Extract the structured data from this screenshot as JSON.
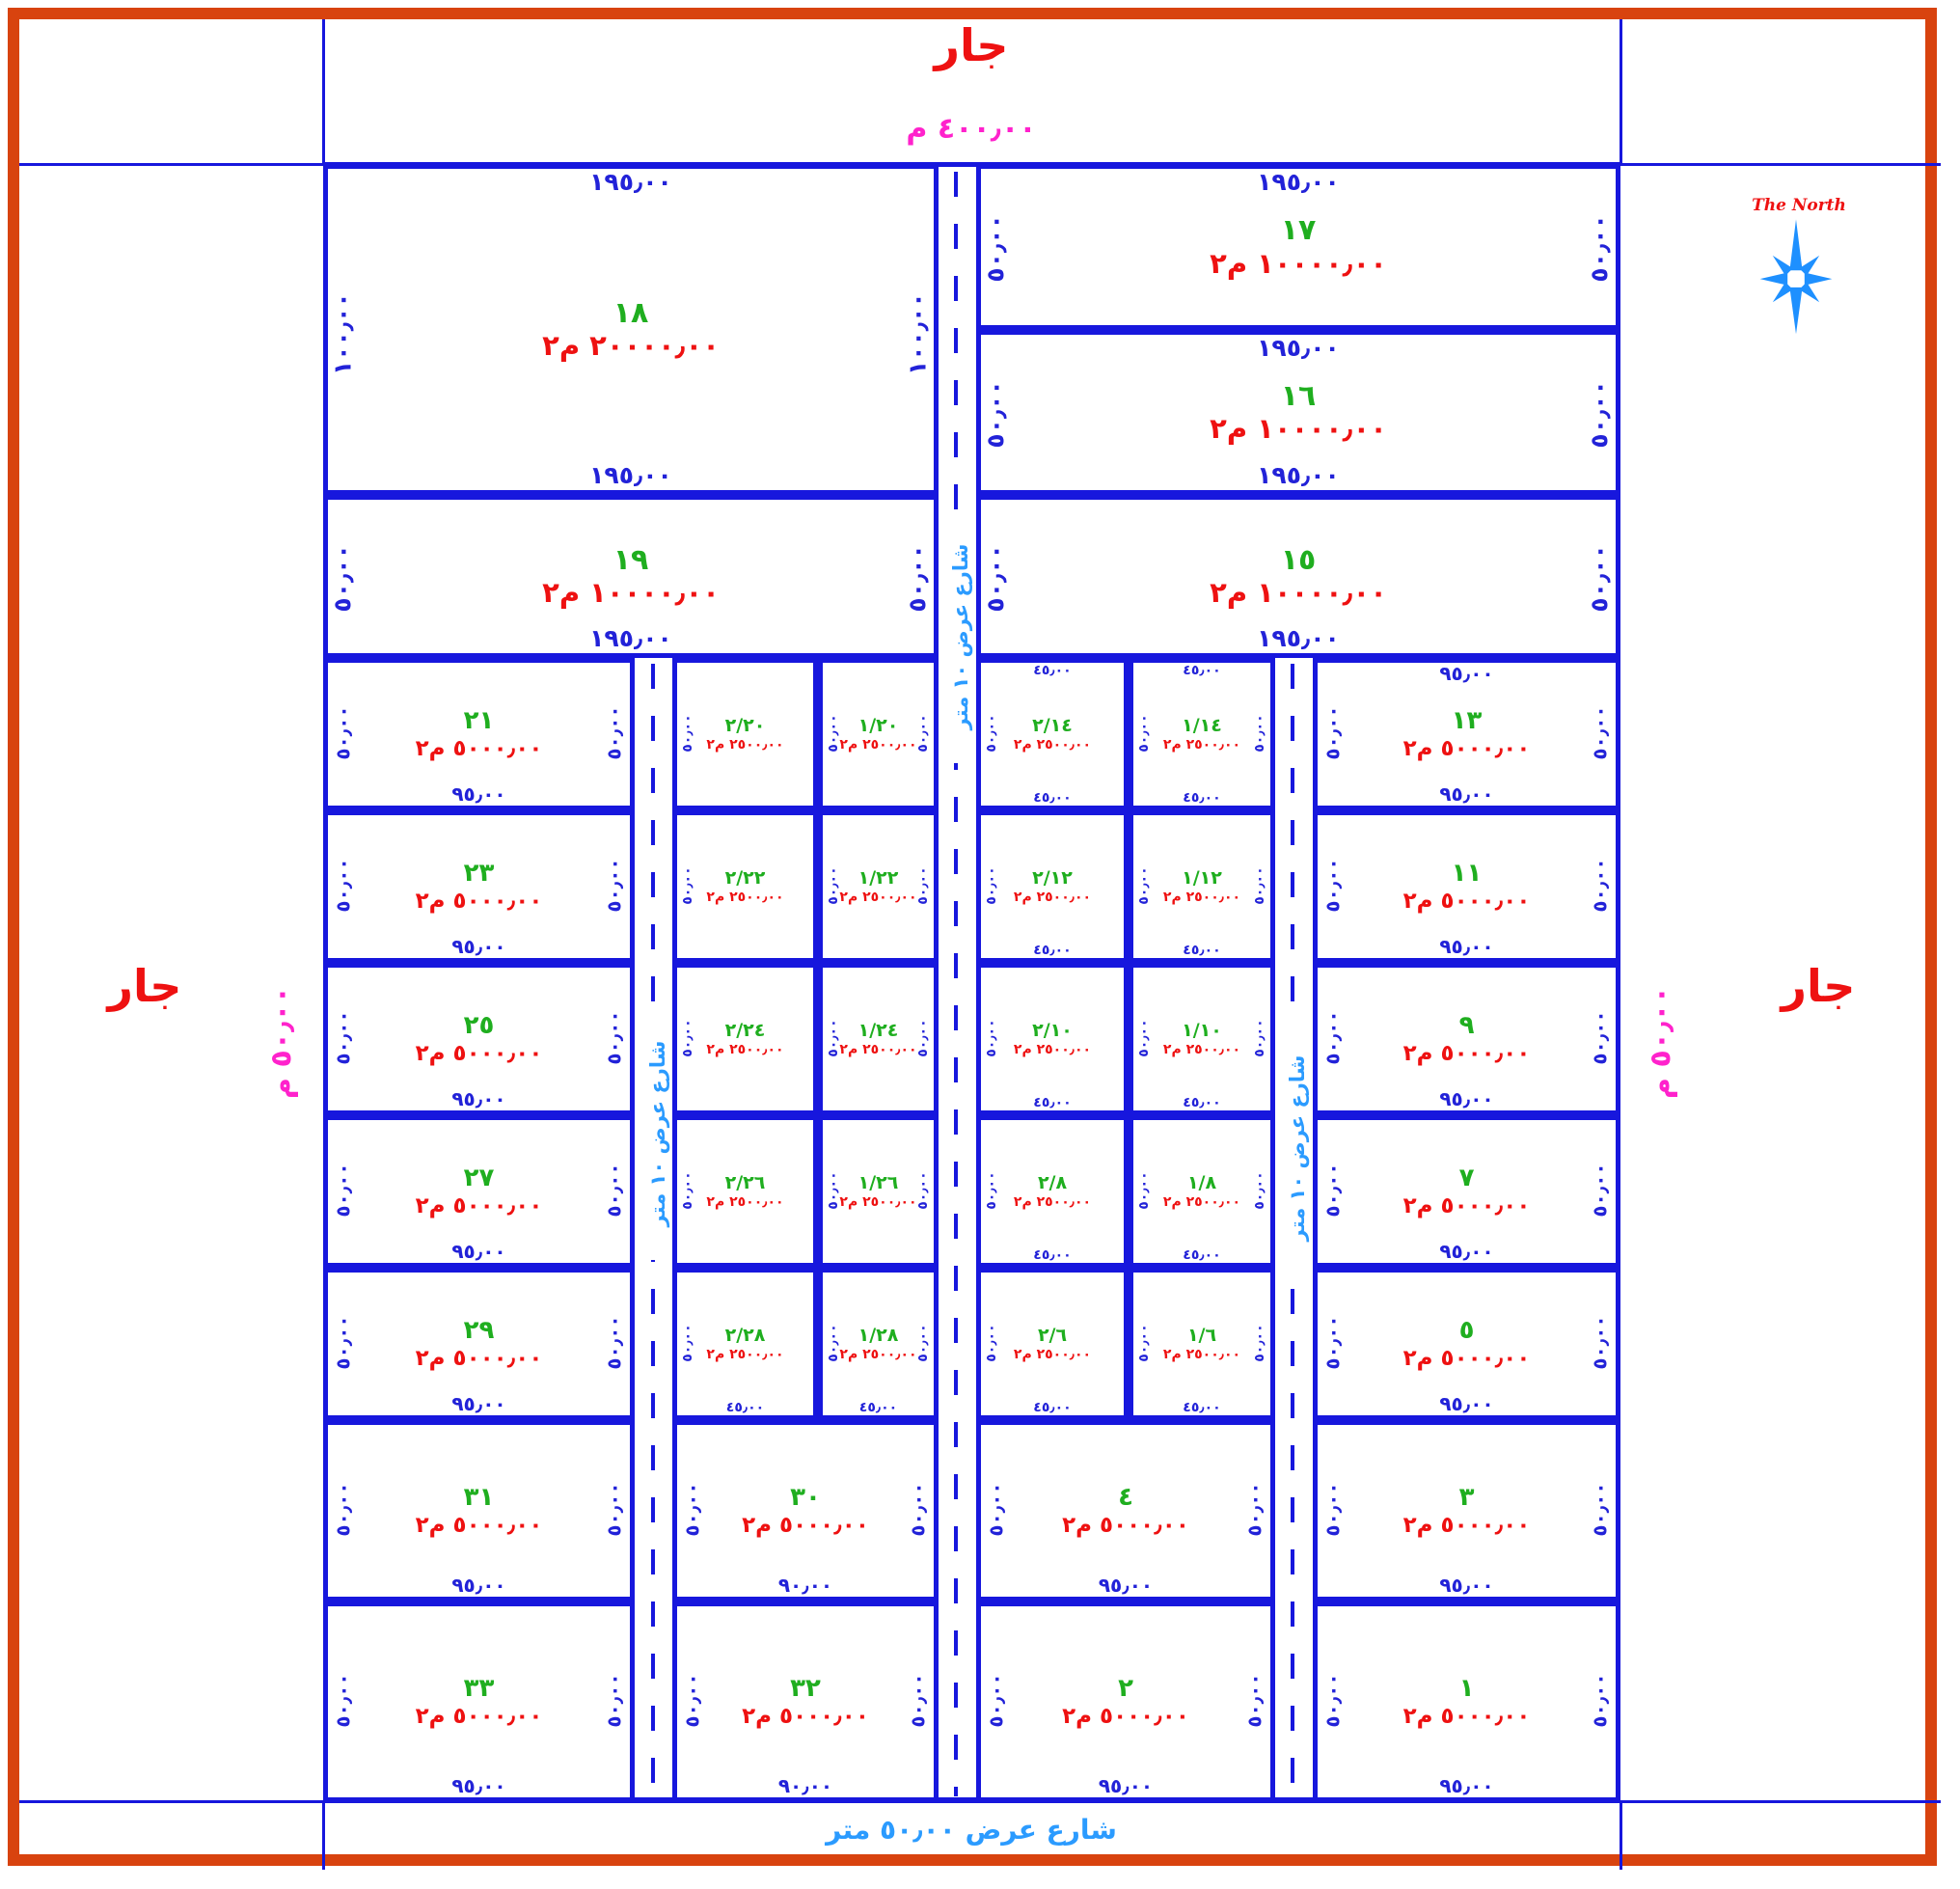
{
  "frame": {
    "top_neighbor": "جار",
    "top_width": "٤٠٠٫٠٠ م",
    "left_neighbor": "جار",
    "left_width": "٥٠٫٠٠ م",
    "right_neighbor": "جار",
    "right_width": "٥٠٫٠٠ م"
  },
  "compass": {
    "label": "The North"
  },
  "streets": {
    "bottom": "شارع عرض ٥٠٫٠٠ متر",
    "center": "شارع عرض ١٠ متر",
    "left": "شارع عرض ١٠ متر",
    "right": "شارع عرض ١٠ متر"
  },
  "colors": {
    "border": "#d8430f",
    "lines": "#1717dd",
    "plot_number": "#1fae1f",
    "area": "#ee1111",
    "dimension": "#2222d8",
    "boundary_dim": "#ff22cc",
    "street_label": "#2b9bff",
    "north_label": "#ee1111"
  },
  "plots": [
    {
      "id": "18",
      "num": "١٨",
      "area": "٢٠٠٠٠٫٠٠ م٢",
      "t": "١٩٥٫٠٠",
      "b": "١٩٥٫٠٠",
      "l": "١٠٠٫٠٠",
      "r": "١٠٠٫٠٠"
    },
    {
      "id": "17",
      "num": "١٧",
      "area": "١٠٠٠٠٫٠٠ م٢",
      "t": "١٩٥٫٠٠",
      "l": "٥٠٫٠٠",
      "r": "٥٠٫٠٠"
    },
    {
      "id": "16",
      "num": "١٦",
      "area": "١٠٠٠٠٫٠٠ م٢",
      "t": "١٩٥٫٠٠",
      "b": "١٩٥٫٠٠",
      "l": "٥٠٫٠٠",
      "r": "٥٠٫٠٠"
    },
    {
      "id": "19",
      "num": "١٩",
      "area": "١٠٠٠٠٫٠٠ م٢",
      "b": "١٩٥٫٠٠",
      "l": "٥٠٫٠٠",
      "r": "٥٠٫٠٠"
    },
    {
      "id": "15",
      "num": "١٥",
      "area": "١٠٠٠٠٫٠٠ م٢",
      "b": "١٩٥٫٠٠",
      "l": "٥٠٫٠٠",
      "r": "٥٠٫٠٠"
    },
    {
      "id": "21",
      "num": "٢١",
      "area": "٥٠٠٠٫٠٠ م٢",
      "b": "٩٥٫٠٠",
      "l": "٥٠٫٠٠",
      "r": "٥٠٫٠٠"
    },
    {
      "id": "2/20",
      "num": "٢/٢٠",
      "area": "٢٥٠٠٫٠٠ م٢",
      "l": "٥٠٫٠٠"
    },
    {
      "id": "1/20",
      "num": "١/٢٠",
      "area": "٢٥٠٠٫٠٠ م٢",
      "l": "٥٠٫٠٠",
      "r": "٥٠٫٠٠"
    },
    {
      "id": "2/14",
      "num": "٢/١٤",
      "area": "٢٥٠٠٫٠٠ م٢",
      "t": "٤٥٫٠٠",
      "b": "٤٥٫٠٠",
      "l": "٥٠٫٠٠"
    },
    {
      "id": "1/14",
      "num": "١/١٤",
      "area": "٢٥٠٠٫٠٠ م٢",
      "t": "٤٥٫٠٠",
      "b": "٤٥٫٠٠",
      "l": "٥٠٫٠٠",
      "r": "٥٠٫٠٠"
    },
    {
      "id": "13",
      "num": "١٣",
      "area": "٥٠٠٠٫٠٠ م٢",
      "t": "٩٥٫٠٠",
      "b": "٩٥٫٠٠",
      "l": "٥٠٫٠٠",
      "r": "٥٠٫٠٠"
    },
    {
      "id": "23",
      "num": "٢٣",
      "area": "٥٠٠٠٫٠٠ م٢",
      "b": "٩٥٫٠٠",
      "l": "٥٠٫٠٠",
      "r": "٥٠٫٠٠"
    },
    {
      "id": "2/22",
      "num": "٢/٢٢",
      "area": "٢٥٠٠٫٠٠ م٢",
      "l": "٥٠٫٠٠"
    },
    {
      "id": "1/22",
      "num": "١/٢٢",
      "area": "٢٥٠٠٫٠٠ م٢",
      "l": "٥٠٫٠٠",
      "r": "٥٠٫٠٠"
    },
    {
      "id": "2/12",
      "num": "٢/١٢",
      "area": "٢٥٠٠٫٠٠ م٢",
      "b": "٤٥٫٠٠",
      "l": "٥٠٫٠٠"
    },
    {
      "id": "1/12",
      "num": "١/١٢",
      "area": "٢٥٠٠٫٠٠ م٢",
      "b": "٤٥٫٠٠",
      "l": "٥٠٫٠٠",
      "r": "٥٠٫٠٠"
    },
    {
      "id": "11",
      "num": "١١",
      "area": "٥٠٠٠٫٠٠ م٢",
      "b": "٩٥٫٠٠",
      "l": "٥٠٫٠٠",
      "r": "٥٠٫٠٠"
    },
    {
      "id": "25",
      "num": "٢٥",
      "area": "٥٠٠٠٫٠٠ م٢",
      "b": "٩٥٫٠٠",
      "l": "٥٠٫٠٠",
      "r": "٥٠٫٠٠"
    },
    {
      "id": "2/24",
      "num": "٢/٢٤",
      "area": "٢٥٠٠٫٠٠ م٢",
      "l": "٥٠٫٠٠"
    },
    {
      "id": "1/24",
      "num": "١/٢٤",
      "area": "٢٥٠٠٫٠٠ م٢",
      "l": "٥٠٫٠٠",
      "r": "٥٠٫٠٠"
    },
    {
      "id": "2/10",
      "num": "٢/١٠",
      "area": "٢٥٠٠٫٠٠ م٢",
      "b": "٤٥٫٠٠",
      "l": "٥٠٫٠٠"
    },
    {
      "id": "1/10",
      "num": "١/١٠",
      "area": "٢٥٠٠٫٠٠ م٢",
      "b": "٤٥٫٠٠",
      "l": "٥٠٫٠٠",
      "r": "٥٠٫٠٠"
    },
    {
      "id": "9",
      "num": "٩",
      "area": "٥٠٠٠٫٠٠ م٢",
      "b": "٩٥٫٠٠",
      "l": "٥٠٫٠٠",
      "r": "٥٠٫٠٠"
    },
    {
      "id": "27",
      "num": "٢٧",
      "area": "٥٠٠٠٫٠٠ م٢",
      "b": "٩٥٫٠٠",
      "l": "٥٠٫٠٠",
      "r": "٥٠٫٠٠"
    },
    {
      "id": "2/26",
      "num": "٢/٢٦",
      "area": "٢٥٠٠٫٠٠ م٢",
      "l": "٥٠٫٠٠"
    },
    {
      "id": "1/26",
      "num": "١/٢٦",
      "area": "٢٥٠٠٫٠٠ م٢",
      "l": "٥٠٫٠٠",
      "r": "٥٠٫٠٠"
    },
    {
      "id": "2/8",
      "num": "٢/٨",
      "area": "٢٥٠٠٫٠٠ م٢",
      "b": "٤٥٫٠٠",
      "l": "٥٠٫٠٠"
    },
    {
      "id": "1/8",
      "num": "١/٨",
      "area": "٢٥٠٠٫٠٠ م٢",
      "b": "٤٥٫٠٠",
      "l": "٥٠٫٠٠",
      "r": "٥٠٫٠٠"
    },
    {
      "id": "7",
      "num": "٧",
      "area": "٥٠٠٠٫٠٠ م٢",
      "b": "٩٥٫٠٠",
      "l": "٥٠٫٠٠",
      "r": "٥٠٫٠٠"
    },
    {
      "id": "29",
      "num": "٢٩",
      "area": "٥٠٠٠٫٠٠ م٢",
      "b": "٩٥٫٠٠",
      "l": "٥٠٫٠٠",
      "r": "٥٠٫٠٠"
    },
    {
      "id": "2/28",
      "num": "٢/٢٨",
      "area": "٢٥٠٠٫٠٠ م٢",
      "b": "٤٥٫٠٠",
      "l": "٥٠٫٠٠"
    },
    {
      "id": "1/28",
      "num": "١/٢٨",
      "area": "٢٥٠٠٫٠٠ م٢",
      "b": "٤٥٫٠٠",
      "l": "٥٠٫٠٠",
      "r": "٥٠٫٠٠"
    },
    {
      "id": "2/6",
      "num": "٢/٦",
      "area": "٢٥٠٠٫٠٠ م٢",
      "b": "٤٥٫٠٠",
      "l": "٥٠٫٠٠"
    },
    {
      "id": "1/6",
      "num": "١/٦",
      "area": "٢٥٠٠٫٠٠ م٢",
      "b": "٤٥٫٠٠",
      "l": "٥٠٫٠٠",
      "r": "٥٠٫٠٠"
    },
    {
      "id": "5",
      "num": "٥",
      "area": "٥٠٠٠٫٠٠ م٢",
      "b": "٩٥٫٠٠",
      "l": "٥٠٫٠٠",
      "r": "٥٠٫٠٠"
    },
    {
      "id": "31",
      "num": "٣١",
      "area": "٥٠٠٠٫٠٠ م٢",
      "b": "٩٥٫٠٠",
      "l": "٥٠٫٠٠",
      "r": "٥٠٫٠٠"
    },
    {
      "id": "30",
      "num": "٣٠",
      "area": "٥٠٠٠٫٠٠ م٢",
      "b": "٩٠٫٠٠",
      "l": "٥٠٫٠٠",
      "r": "٥٠٫٠٠"
    },
    {
      "id": "4",
      "num": "٤",
      "area": "٥٠٠٠٫٠٠ م٢",
      "b": "٩٥٫٠٠",
      "l": "٥٠٫٠٠",
      "r": "٥٠٫٠٠"
    },
    {
      "id": "3",
      "num": "٣",
      "area": "٥٠٠٠٫٠٠ م٢",
      "b": "٩٥٫٠٠",
      "l": "٥٠٫٠٠",
      "r": "٥٠٫٠٠"
    },
    {
      "id": "33",
      "num": "٣٣",
      "area": "٥٠٠٠٫٠٠ م٢",
      "b": "٩٥٫٠٠",
      "l": "٥٠٫٠٠",
      "r": "٥٠٫٠٠"
    },
    {
      "id": "32",
      "num": "٣٢",
      "area": "٥٠٠٠٫٠٠ م٢",
      "b": "٩٠٫٠٠",
      "l": "٥٠٫٠٠",
      "r": "٥٠٫٠٠"
    },
    {
      "id": "2",
      "num": "٢",
      "area": "٥٠٠٠٫٠٠ م٢",
      "b": "٩٥٫٠٠",
      "l": "٥٠٫٠٠",
      "r": "٥٠٫٠٠"
    },
    {
      "id": "1",
      "num": "١",
      "area": "٥٠٠٠٫٠٠ م٢",
      "b": "٩٥٫٠٠",
      "l": "٥٠٫٠٠",
      "r": "٥٠٫٠٠"
    }
  ]
}
